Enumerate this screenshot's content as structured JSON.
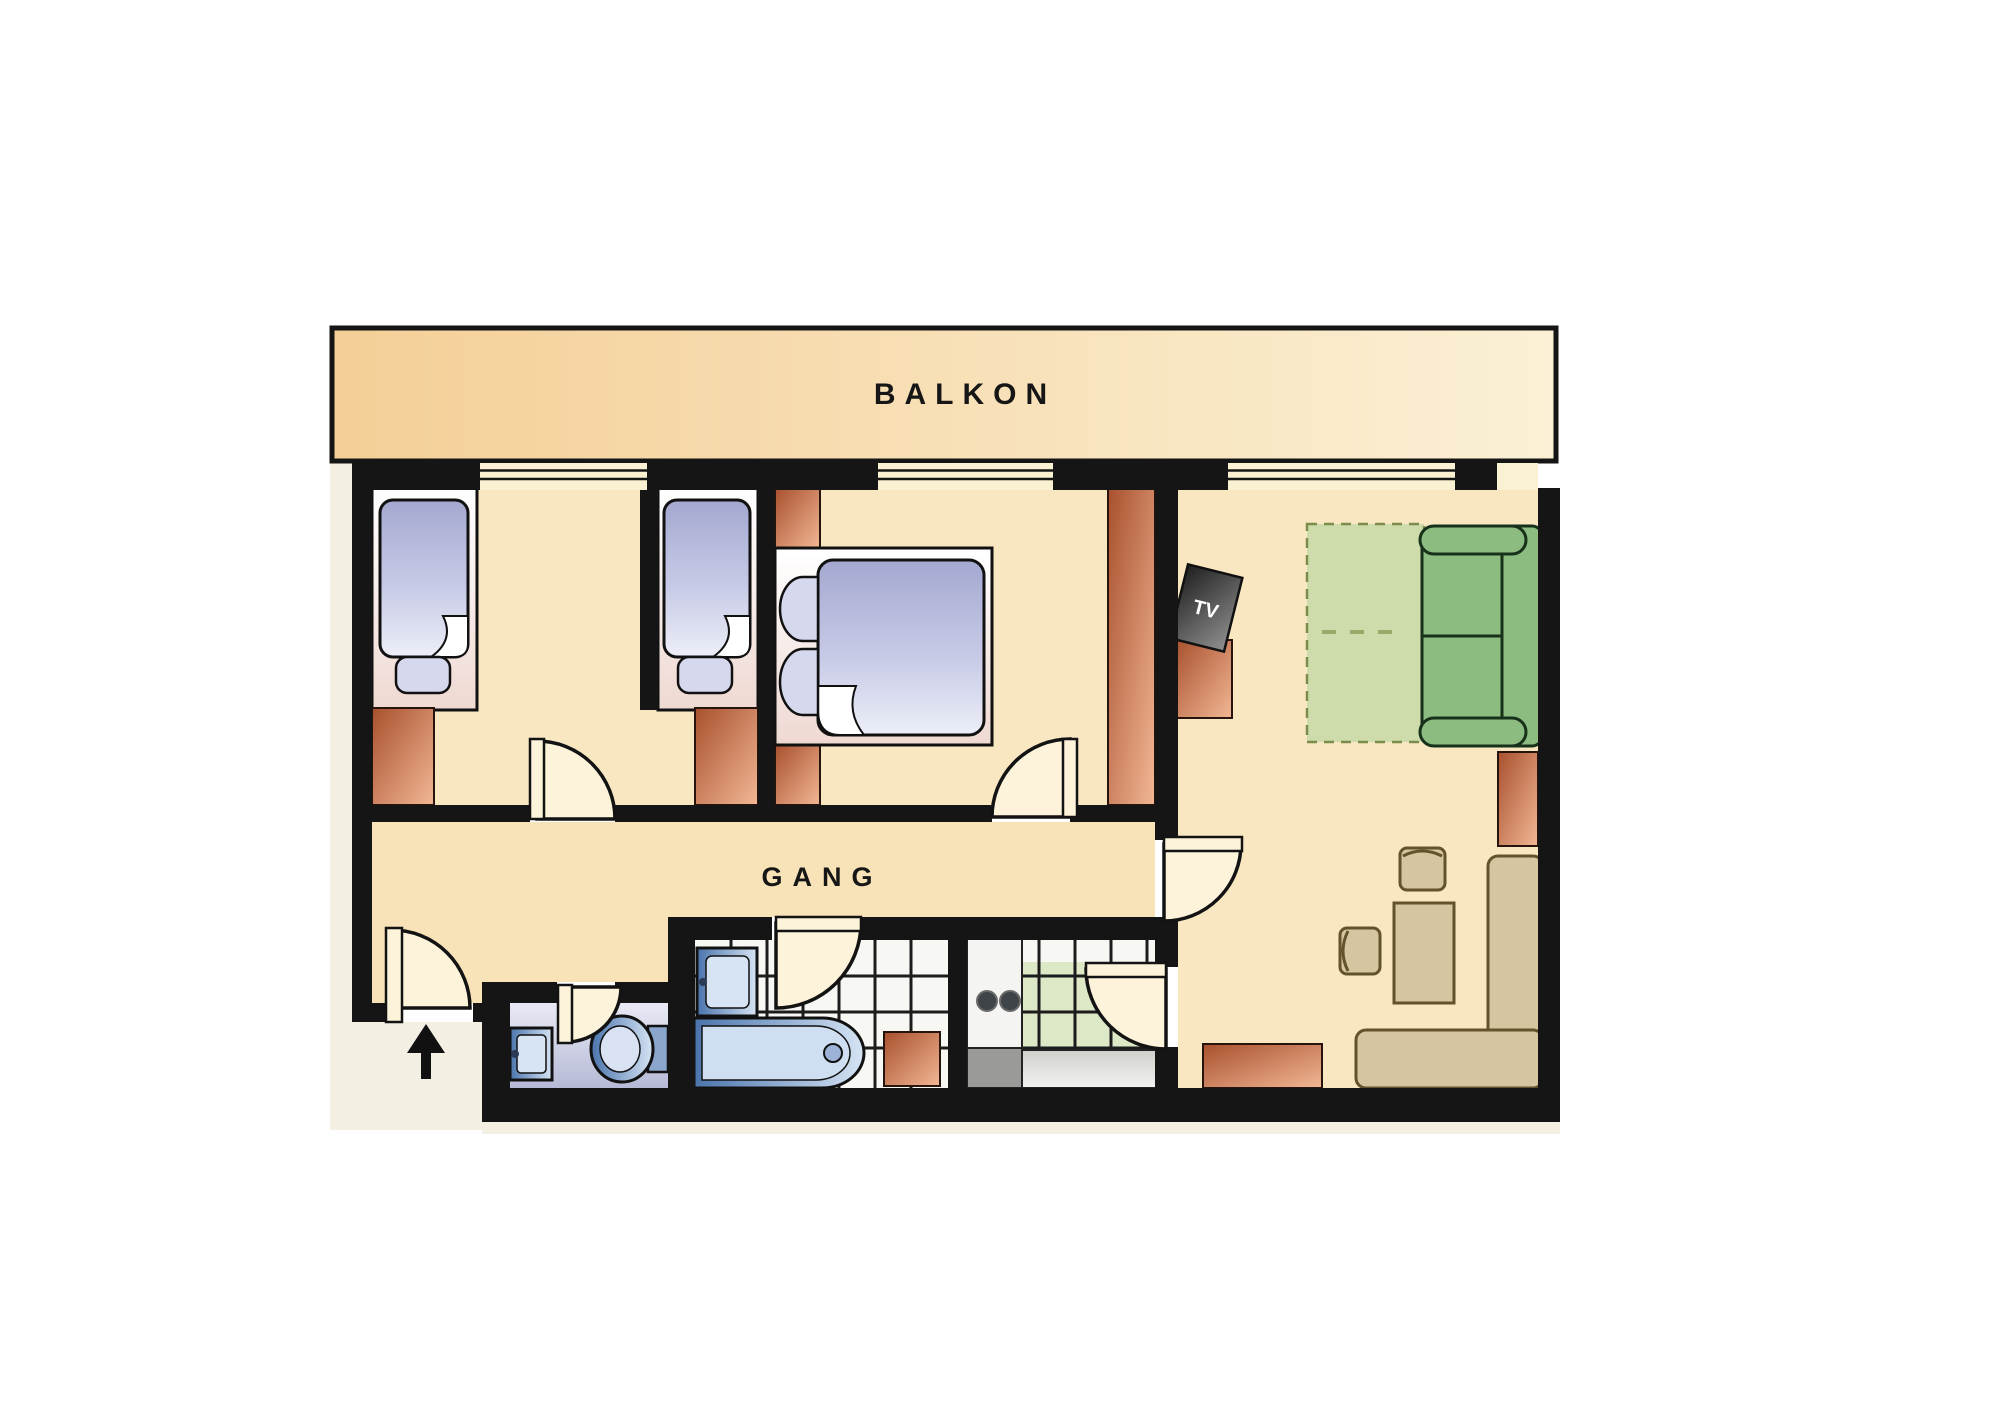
{
  "title": "Apartment floor plan",
  "labels": {
    "balcony": "BALKON",
    "hallway": "GANG",
    "tv": "TV"
  },
  "palette": {
    "wall": "#151515",
    "floor": "#f9e7c2",
    "gang-floor": "#f8e3b8",
    "balc-a": "#f4cf97",
    "balc-b": "#fbf0d5",
    "outside": "#f3efe2",
    "terr-a": "#a8502e",
    "terr-b": "#f2b794",
    "bed-a": "#a4a8d0",
    "bed-b": "#eceef8",
    "pillow": "#d6d9ee",
    "plat-a": "#ffffff",
    "plat-b": "#efd9d2",
    "blue-a": "#4a74ac",
    "blue-b": "#d6e4f4",
    "wcf-a": "#e9eaf5",
    "wcf-b": "#b6bad6",
    "tile": "#f7f7f4",
    "tile-green": "#dce8c6",
    "grid": "#1c1c1c",
    "rug": "#cddcaa",
    "rug-bd": "#7c8c4c",
    "sofa": "#8cbc80",
    "tan": "#d5c5a0",
    "tan-bd": "#63522c",
    "tv-a": "#1f1f1f",
    "tv-b": "#909090",
    "door": "#fdf3da",
    "window": "#faf0d2",
    "label": "#161616"
  }
}
